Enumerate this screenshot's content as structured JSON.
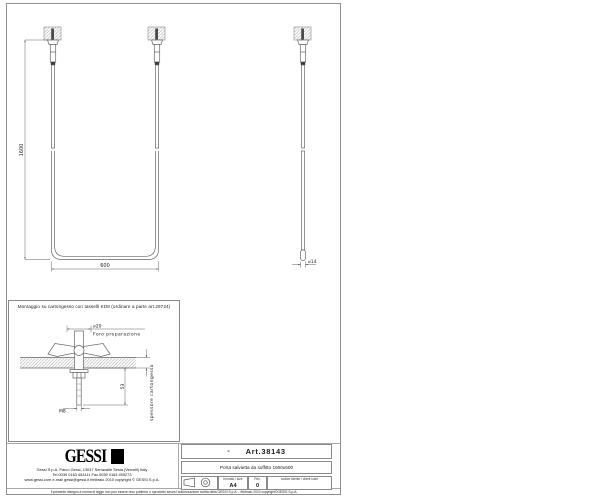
{
  "sheet": {
    "front_view": {
      "dim_height": "1600",
      "dim_width": "600"
    },
    "side_view": {
      "dim_diameter": "⌀14"
    },
    "detail_inset": {
      "title": "Montaggio su cartongesso con tasselli KD8 (ordinare a parte art.29724)",
      "hole_diameter": "⌀20",
      "hole_label": "Foro  preparazione",
      "depth_dim": "53",
      "thread_label": "M8",
      "wall_label": "spessore  cartongesso"
    },
    "footer": {
      "logo_text": "GESSI",
      "address_line1": "Gessi  S.p.A.  Parco  Gessi,  13037  Serravalle  Sesia  (Vercelli)  Italy",
      "address_line2": "Tel.0039  0163  454111  Fax.0039  0163  459273",
      "address_line3": "www.gessi.com  e-mail  gessi@gessi.it   febbraio  2010   copyright © GESSI  S.p.A.",
      "disclaimer": "Il presente disegno a norma di legge non può essere reso pubblico o riprodotto senza l'autorizzazione scritta della GESSI S.p.A.  -  febbraio 2010   copyright©GESSI S.p.A."
    },
    "title_block": {
      "dash": "-",
      "art_number": "Art.38143",
      "description": "Porta salvietta da soffitto 1600x600",
      "format_label": "formato / size",
      "format_value": "A4",
      "rev_label": "Rev.",
      "rev_value": "0",
      "client_code_label": "codice cliente / client code",
      "client_code_value": ""
    },
    "colors": {
      "object_line": "#666666",
      "dim_line": "#555555",
      "frame": "#8f8f8f",
      "ink": "#111111"
    }
  }
}
